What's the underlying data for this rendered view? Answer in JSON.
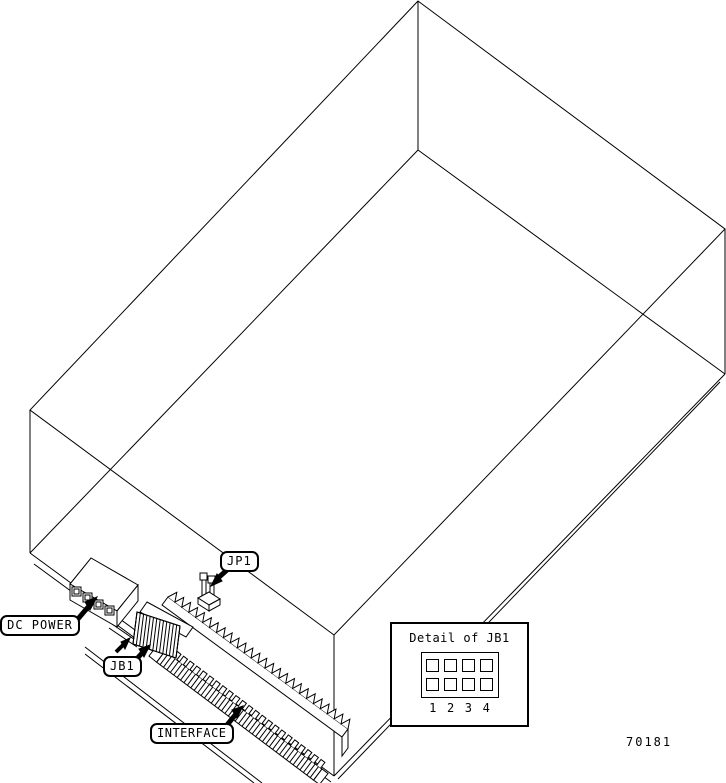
{
  "figure_number": "70181",
  "labels": {
    "jp1": "JP1",
    "dc_power": "DC POWER",
    "jb1": "JB1",
    "interface": "INTERFACE"
  },
  "detail_box": {
    "title": "Detail of JB1",
    "pin_numbers": [
      "1",
      "2",
      "3",
      "4"
    ],
    "jumper_rows": 2,
    "jumper_cols": 4
  },
  "colors": {
    "line": "#000000",
    "background": "#ffffff"
  }
}
